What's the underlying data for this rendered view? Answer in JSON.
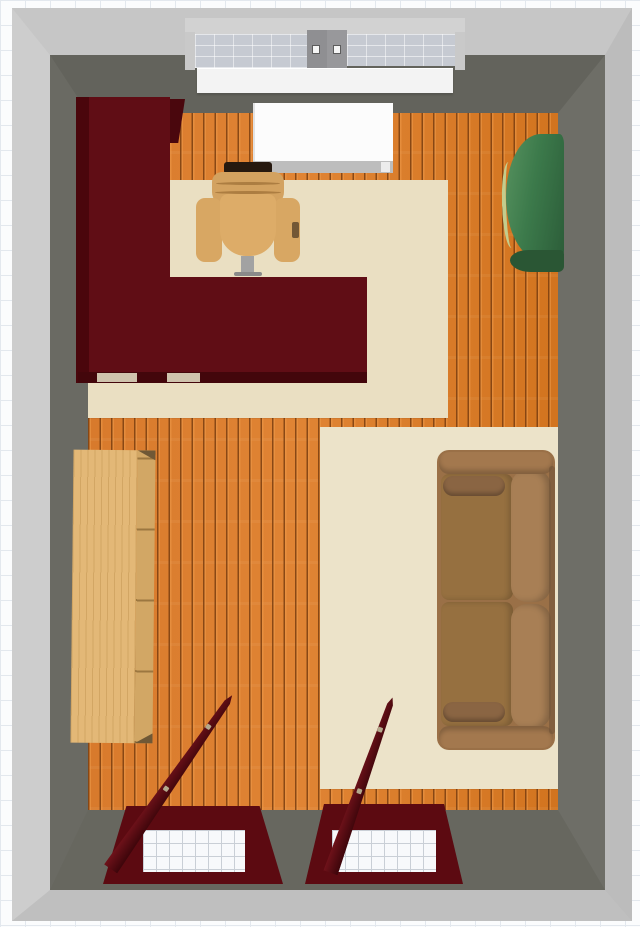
{
  "app": {
    "view": "3d-room-plan-aerial-view",
    "visible_text": "",
    "description": "Top-down 3D render of a rectangular room on a drafting grid canvas"
  },
  "colors": {
    "canvas": "#fbfcfd",
    "grid": "#e3e8ee",
    "wall-outer": "#c6c6c6",
    "wall-inner": "#6a6a63",
    "floor": "#d97e31",
    "rug": "#eadfc2",
    "glass": "#c6cad2",
    "sill": "#f3f3f3",
    "white-table": "#fcfcfc",
    "desk": "#600d15",
    "desk-edge": "#43060b",
    "chair": "#d8a763",
    "chair-headrest": "#26190f",
    "cabinet": "#3c7a4b",
    "cabinet-front": "#2a5634",
    "cabinet-shine": "#c3cd8d",
    "bookshelf": "#e3b877",
    "bookshelf-edge": "#d2a765",
    "sofa": "#9a7047",
    "sofa-seat": "#967040",
    "sofa-back": "#a87f55",
    "sofa-bolster": "#8a6543",
    "bwindow": "#5c0a11",
    "bglass-line": "#c9cfd6"
  },
  "scene": {
    "room": {
      "walls": "gray band with dark inner faces",
      "floor": "orange wood planks, vertical boards",
      "rugs": [
        "cream rug under desk area",
        "cream rug under sofa area"
      ]
    },
    "objects": [
      {
        "name": "top-casement-window",
        "color": "gray frame, two panes, white sill"
      },
      {
        "name": "white-top-table",
        "color": "white"
      },
      {
        "name": "l-shaped-desk",
        "color": "dark red"
      },
      {
        "name": "office-chair",
        "color": "tan"
      },
      {
        "name": "green-curved-console",
        "color": "green"
      },
      {
        "name": "bookshelf",
        "color": "light wood"
      },
      {
        "name": "two-seat-sofa",
        "color": "brown"
      },
      {
        "name": "bottom-hopper-window-left",
        "color": "dark red frame, open sash"
      },
      {
        "name": "bottom-hopper-window-right",
        "color": "dark red frame, open sash"
      }
    ]
  }
}
